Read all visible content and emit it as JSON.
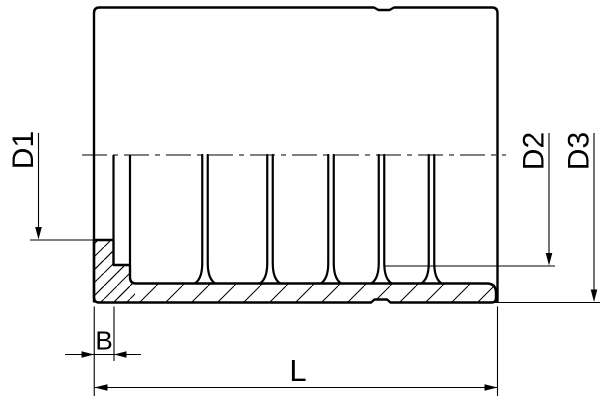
{
  "drawing": {
    "background_color": "#ffffff",
    "line_color": "#000000",
    "dimension_labels": {
      "d1": "D1",
      "d2": "D2",
      "d3": "D3",
      "b": "B",
      "l": "L"
    }
  }
}
